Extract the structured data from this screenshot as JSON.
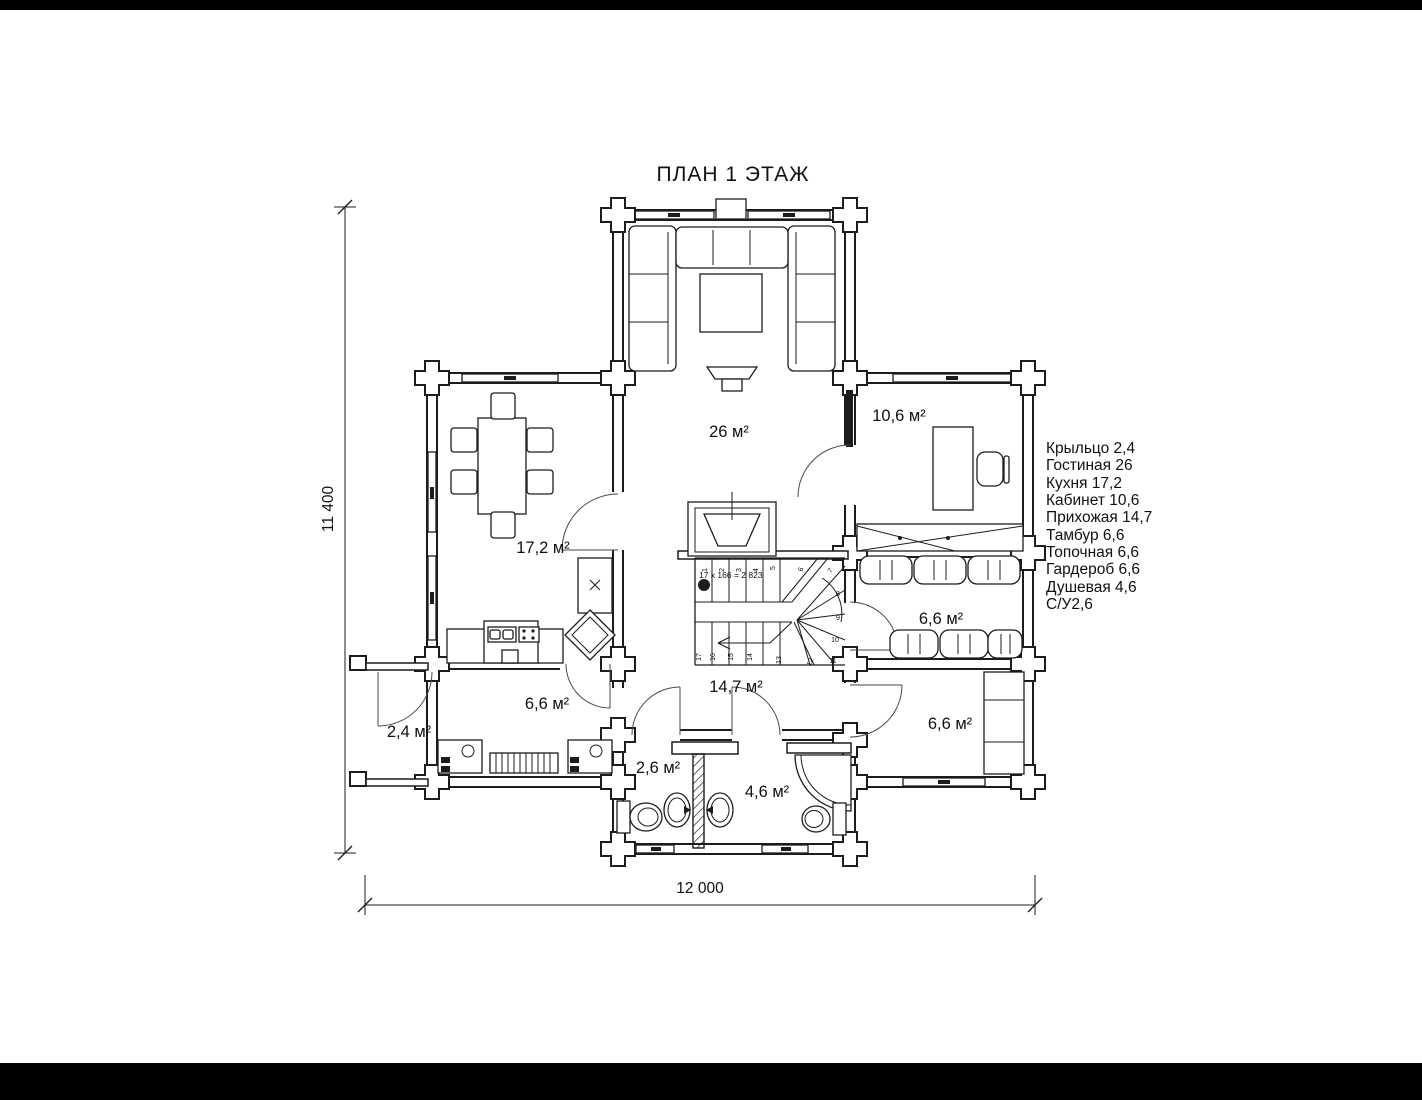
{
  "title": "ПЛАН 1 ЭТАЖ",
  "legend": {
    "items": [
      "Крыльцо 2,4",
      "Гостиная 26",
      "Кухня 17,2",
      "Кабинет 10,6",
      "Прихожая 14,7",
      "Тамбур 6,6",
      "Топочная 6,6",
      "Гардероб 6,6",
      "Душевая 4,6",
      "С/У2,6"
    ]
  },
  "rooms": {
    "living": "26 м²",
    "office": "10,6 м²",
    "kitchen": "17,2 м²",
    "wardrobe": "6,6 м²",
    "boiler": "6,6 м²",
    "hall": "14,7 м²",
    "tambour": "6,6 м²",
    "porch": "2,4 м²",
    "wc": "2,6 м²",
    "shower": "4,6 м²"
  },
  "dimensions": {
    "overall_width": "12 000",
    "overall_height": "11 400"
  },
  "stairs": {
    "formula": "17 x 166 = 2 823",
    "numbers": [
      "1",
      "2",
      "3",
      "4",
      "5",
      "6",
      "7",
      "8",
      "9",
      "10",
      "11",
      "12",
      "13",
      "14",
      "15",
      "16",
      "17"
    ]
  },
  "colors": {
    "line": "#1c1c1c",
    "paper": "#ffffff",
    "letterbox": "#000000"
  }
}
